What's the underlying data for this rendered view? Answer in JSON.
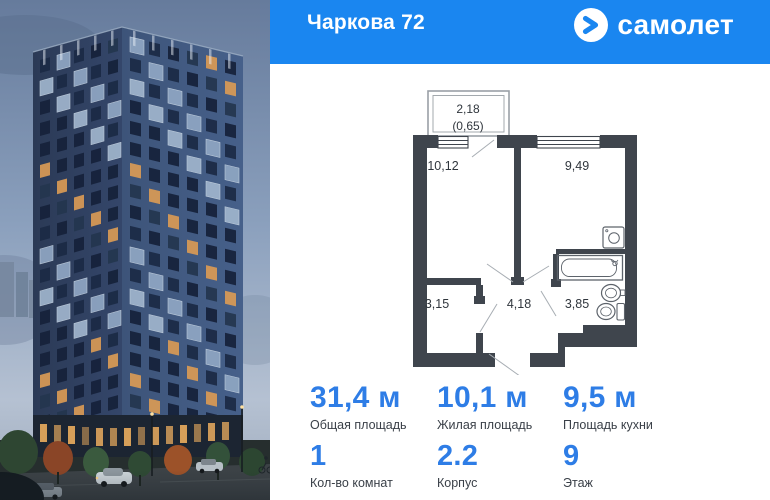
{
  "header": {
    "title": "Чаркова 72",
    "brand": "самолет"
  },
  "floorplan": {
    "balcony": {
      "size": "2,18",
      "coef": "(0,65)"
    },
    "rooms": {
      "living": "10,12",
      "bedroom": "9,49",
      "wardrobe": "3,15",
      "hall": "4,18",
      "bath": "3,85"
    }
  },
  "stats": {
    "total": {
      "value": "31,4 м",
      "label": "Общая площадь"
    },
    "living": {
      "value": "10,1 м",
      "label": "Жилая площадь"
    },
    "kitchen": {
      "value": "9,5 м",
      "label": "Площадь кухни"
    },
    "rooms": {
      "value": "1",
      "label": "Кол-во комнат"
    },
    "building": {
      "value": "2.2",
      "label": "Корпус"
    },
    "floor": {
      "value": "9",
      "label": "Этаж"
    }
  },
  "colors": {
    "brand_blue": "#1a86f0",
    "stat_blue": "#2e7de6",
    "wall_gray": "#3f454d",
    "label_dark": "#3a4048"
  }
}
